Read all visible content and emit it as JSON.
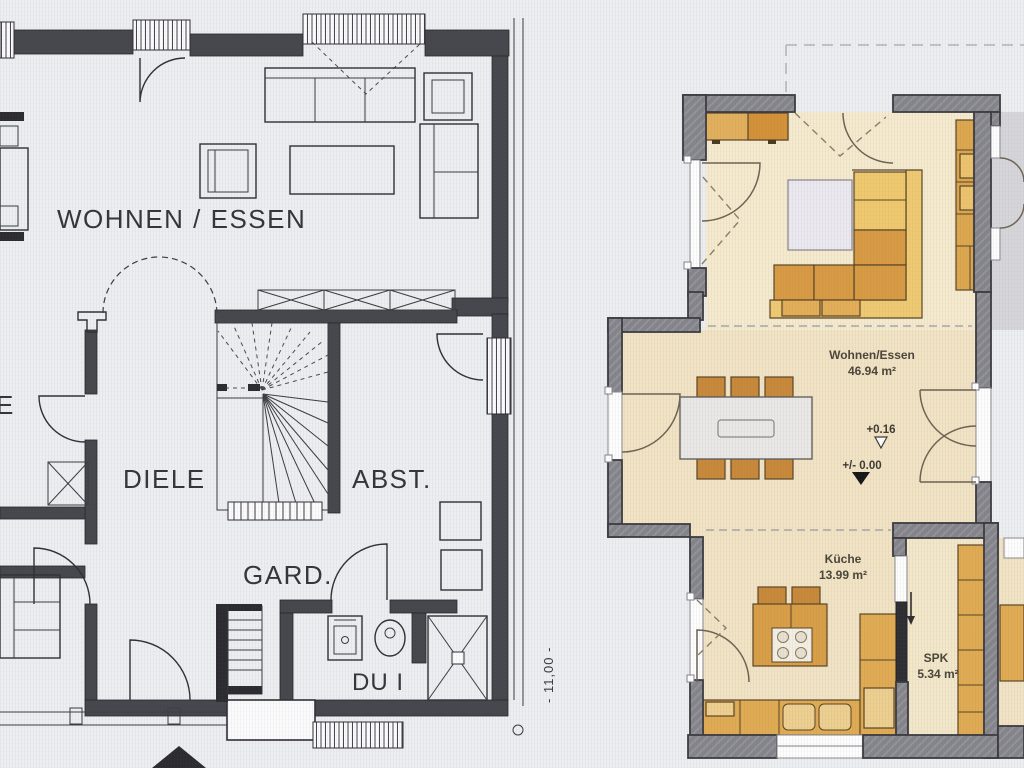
{
  "left_plan": {
    "labels": {
      "living_dining": "WOHNEN / ESSEN",
      "hallway": "DIELE",
      "storage": "ABST.",
      "wardrobe": "GARD.",
      "shower": "DU I",
      "cut_room": "E"
    },
    "dimension_width": "- 11,00 -"
  },
  "right_plan": {
    "living_dining": {
      "name": "Wohnen/Essen",
      "area": "46.94 m²"
    },
    "kitchen": {
      "name": "Küche",
      "area": "13.99 m²"
    },
    "pantry": {
      "name": "SPK",
      "area": "5.34 m²"
    },
    "levels": {
      "floor_upper": "+0.16",
      "floor_zero": "+/- 0.00"
    }
  },
  "colors": {
    "background": "#edeef0",
    "plan_line": "#2f2f34",
    "wall_gray": "#84848a",
    "wall_outline": "#3b3b40",
    "floor_living": "#f5eacd",
    "floor_beige": "#f1e3c3",
    "floor_pantry": "#f3e7c9",
    "neighbor_floor": "#d6d6da",
    "furniture_orange": "#d99f47",
    "furniture_light": "#eec76d",
    "furniture_dark": "#c8893a",
    "table_white": "#eae8e6"
  }
}
